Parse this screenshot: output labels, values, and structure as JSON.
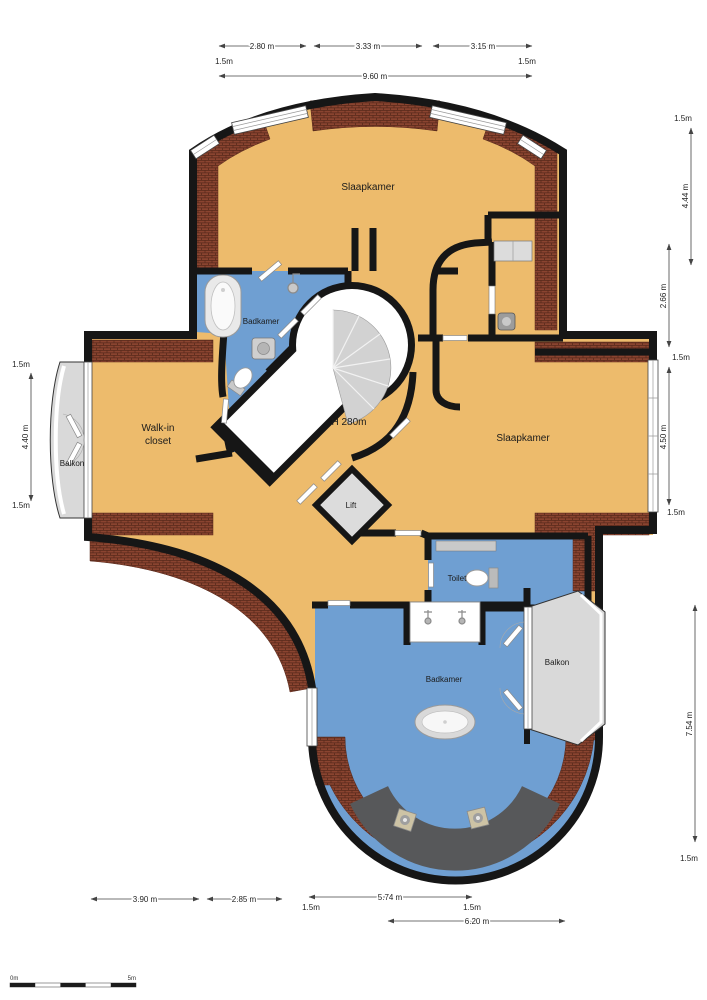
{
  "plan": {
    "rooms": {
      "bedroom_top": "Slaapkamer",
      "bathroom_top": "Badkamer",
      "walkin_line1": "Walk-in",
      "walkin_line2": "closet",
      "height_label": "H 280m",
      "bedroom_right": "Slaapkamer",
      "balcony_left": "Balkon",
      "lift": "Lift",
      "toilet": "Toilet",
      "bathroom_bottom": "Badkamer",
      "balcony_right": "Balkon"
    },
    "dims": {
      "top_seg1": "2.80 m",
      "top_seg2": "3.33 m",
      "top_seg3": "3.15 m",
      "top_margin_left": "1.5m",
      "top_margin_right": "1.5m",
      "top_total": "9.60 m",
      "left_margin_top": "1.5m",
      "left_height": "4.40 m",
      "left_margin_bottom": "1.5m",
      "right_margin_top": "1.5m",
      "right_upper": "4.44 m",
      "right_mid": "2.66 m",
      "right_margin_mid1": "1.5m",
      "right_lower": "4.50 m",
      "right_margin_mid2": "1.5m",
      "right_bottom": "7.54 m",
      "right_margin_bottom": "1.5m",
      "bottom_seg1": "3.90 m",
      "bottom_seg2": "2.85 m",
      "bottom_seg3": "5.74 m",
      "bottom_margin_left": "1.5m",
      "bottom_margin_right": "1.5m",
      "bottom_total": "6.20 m"
    },
    "scale_bar": {
      "start": "0m",
      "end": "5m"
    },
    "colors": {
      "floor": "#edbb6c",
      "wet_floor": "#6f9fd2",
      "brick": "#8a4430",
      "wall": "#161616",
      "outdoor": "#d9d9d9",
      "stairs": "#d2d2d2",
      "shower": "#57585a"
    }
  }
}
